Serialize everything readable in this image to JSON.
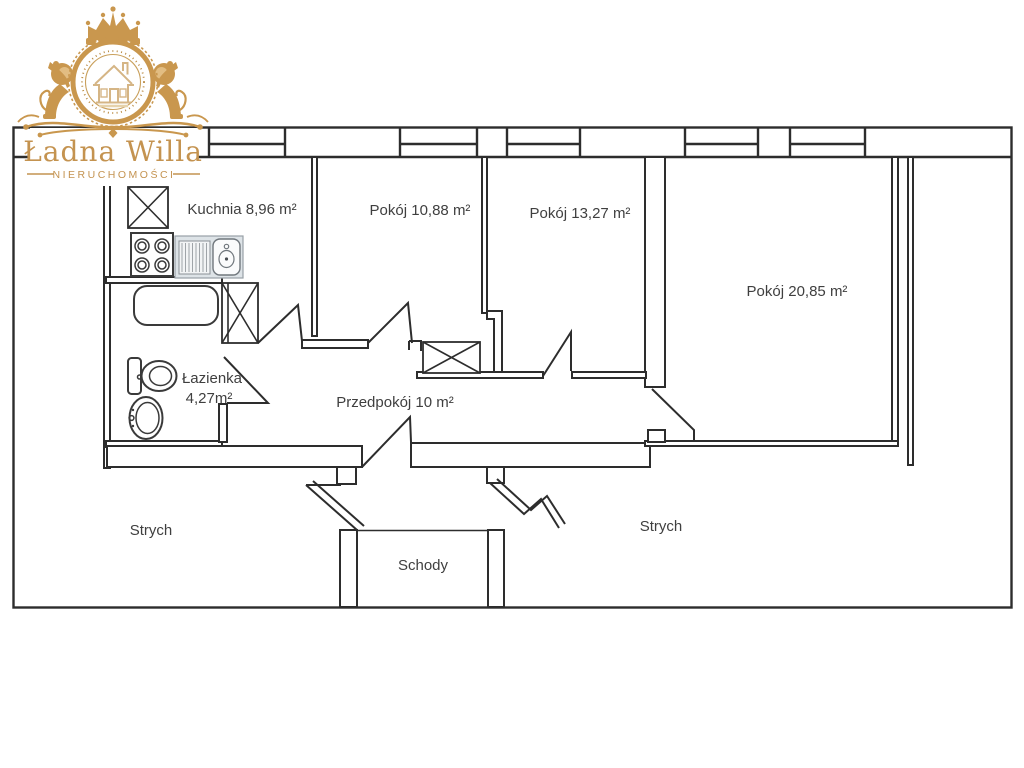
{
  "brand": {
    "name": "Ładna Willa",
    "tagline": "NIERUCHOMOŚCI",
    "gold": "#c49350"
  },
  "floorplan": {
    "line_color": "#2d2d2d",
    "text_color": "#3f3f3f",
    "rooms": [
      {
        "name": "Kuchnia",
        "area": "8,96 m²",
        "label": "Kuchnia 8,96 m²"
      },
      {
        "name": "Pokój",
        "area": "10,88 m²",
        "label": "Pokój 10,88 m²"
      },
      {
        "name": "Pokój",
        "area": "13,27 m²",
        "label": "Pokój 13,27 m²"
      },
      {
        "name": "Pokój",
        "area": "20,85 m²",
        "label": "Pokój 20,85 m²"
      },
      {
        "name": "Łazienka",
        "area": "4,27 m²",
        "label_line1": "Łazienka",
        "label_line2": "4,27m²"
      },
      {
        "name": "Przedpokój",
        "area": "10 m²",
        "label": "Przedpokój 10 m²"
      },
      {
        "name": "Strych (lewy)",
        "label": "Strych"
      },
      {
        "name": "Strych (prawy)",
        "label": "Strych"
      },
      {
        "name": "Schody",
        "label": "Schody"
      }
    ]
  }
}
